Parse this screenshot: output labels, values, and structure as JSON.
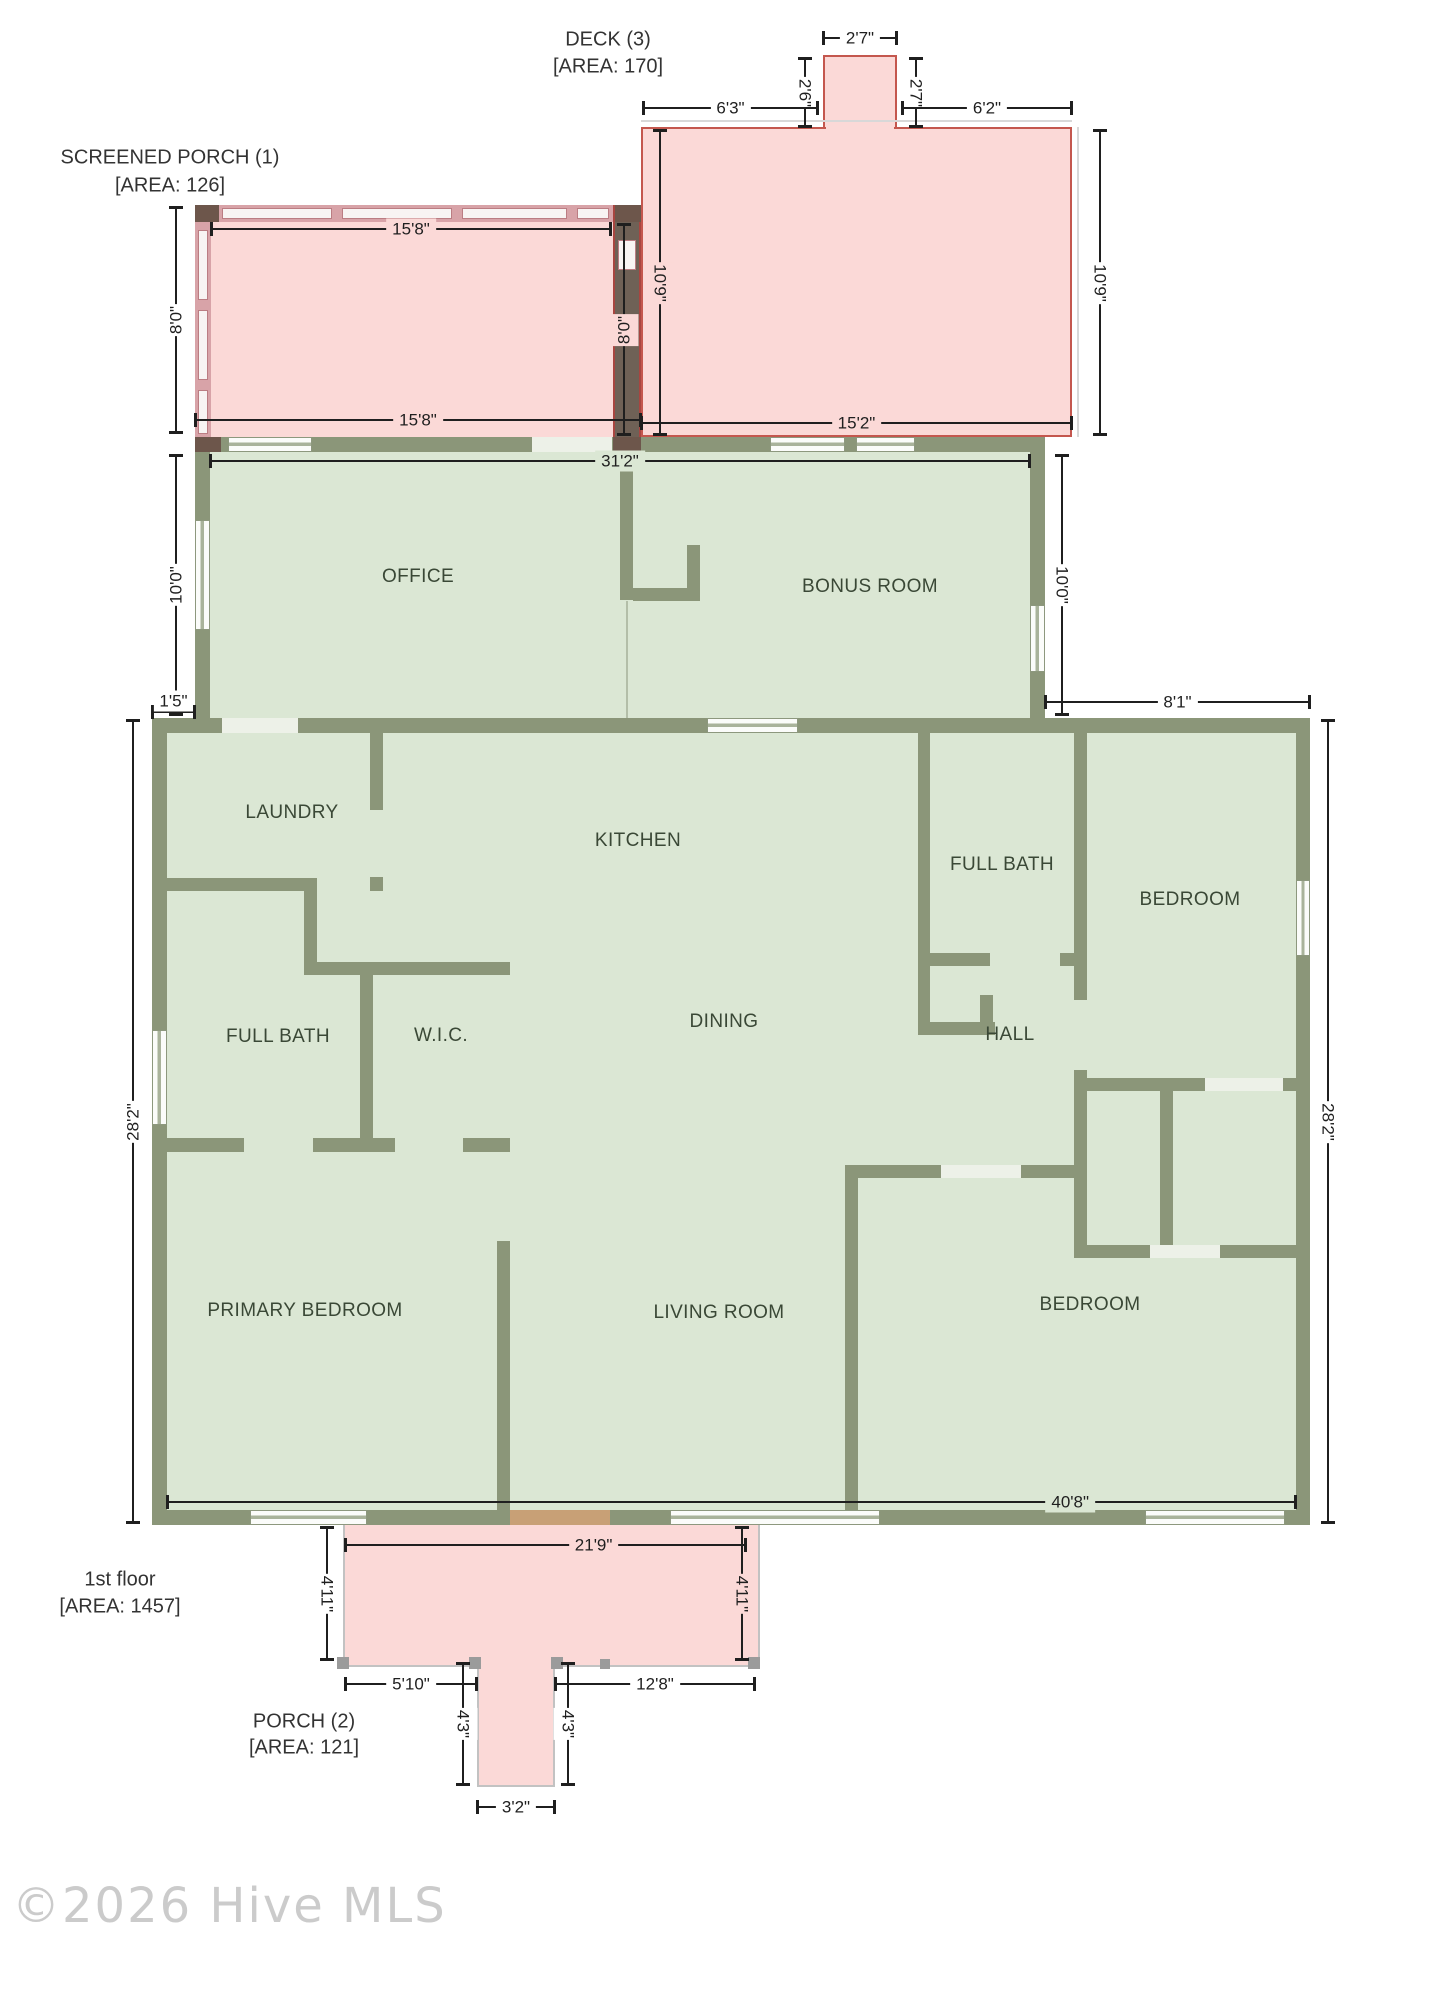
{
  "watermark": "©2026 Hive MLS",
  "areas": {
    "deck": {
      "name": "DECK (3)",
      "area": "[AREA: 170]"
    },
    "screened_porch": {
      "name": "SCREENED PORCH (1)",
      "area": "[AREA: 126]"
    },
    "first_floor": {
      "name": "1st floor",
      "area": "[AREA: 1457]"
    },
    "porch": {
      "name": "PORCH (2)",
      "area": "[AREA: 121]"
    }
  },
  "rooms": {
    "office": {
      "label": "OFFICE"
    },
    "bonus": {
      "label": "BONUS ROOM"
    },
    "laundry": {
      "label": "LAUNDRY"
    },
    "kitchen": {
      "label": "KITCHEN"
    },
    "full_bath_1": {
      "label": "FULL BATH"
    },
    "wic": {
      "label": "W.I.C."
    },
    "dining": {
      "label": "DINING"
    },
    "full_bath_2": {
      "label": "FULL BATH"
    },
    "hall": {
      "label": "HALL"
    },
    "bedroom_1": {
      "label": "BEDROOM"
    },
    "primary_bedroom": {
      "label": "PRIMARY BEDROOM"
    },
    "living": {
      "label": "LIVING ROOM"
    },
    "bedroom_2": {
      "label": "BEDROOM"
    }
  },
  "dims": {
    "deck_bump_width": "2'7\"",
    "deck_bump_left": "2'6\"",
    "deck_bump_right": "2'7\"",
    "deck_top_left": "6'3\"",
    "deck_top_right": "6'2\"",
    "deck_side_left": "10'9\"",
    "deck_side_right": "10'9\"",
    "deck_bottom": "15'2\"",
    "divider_height": "8'0\"",
    "sporch_top": "15'8\"",
    "sporch_side": "8'0\"",
    "sporch_bottom": "15'8\"",
    "upper_width": "31'2\"",
    "office_height": "10'0\"",
    "bonus_height": "10'0\"",
    "left_offset": "1'5\"",
    "right_extension": "8'1\"",
    "main_height_left": "28'2\"",
    "main_height_right": "28'2\"",
    "main_width": "40'8\"",
    "porch_width": "21'9\"",
    "porch_height_left": "4'11\"",
    "porch_height_right": "4'11\"",
    "porch_bottom_left": "5'10\"",
    "porch_bottom_right": "12'8\"",
    "steps_height_left": "4'3\"",
    "steps_height_right": "4'3\"",
    "steps_width": "3'2\""
  },
  "colors": {
    "interior": "#dbe7d4",
    "wall": "#8b9679",
    "porch_fill": "#fbd9d7",
    "deck_outline": "#c4574e",
    "dim_text": "#1f1f1f"
  }
}
